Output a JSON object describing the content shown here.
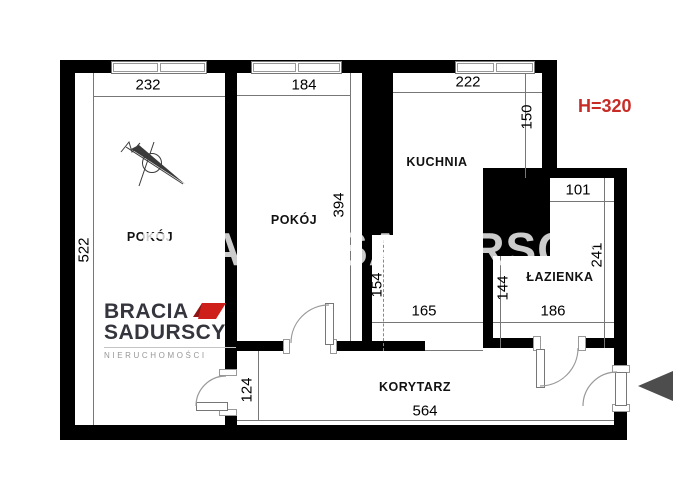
{
  "page": {
    "watermark": "BRACIA SADURSCY",
    "ceiling_height_label": "H=320"
  },
  "rooms": {
    "room1": "POKÓJ",
    "room2": "POKÓJ",
    "kitchen": "KUCHNIA",
    "bathroom": "ŁAZIENKA",
    "corridor": "KORYTARZ"
  },
  "dimensions": {
    "d232": "232",
    "d184": "184",
    "d222": "222",
    "d522": "522",
    "d394": "394",
    "d150": "150",
    "d154": "154",
    "d165": "165",
    "d101": "101",
    "d241": "241",
    "d144": "144",
    "d186": "186",
    "d124": "124",
    "d564": "564"
  },
  "logo": {
    "brand_top": "BRACIA",
    "brand_bottom": "SADURSCY",
    "tagline": "NIERUCHOMOŚCI"
  },
  "colors": {
    "wall": "#000000",
    "ceiling_height_red": "#c72c26",
    "logo_red": "#cf1f1b",
    "arrow_gray": "#4d4d4d"
  }
}
